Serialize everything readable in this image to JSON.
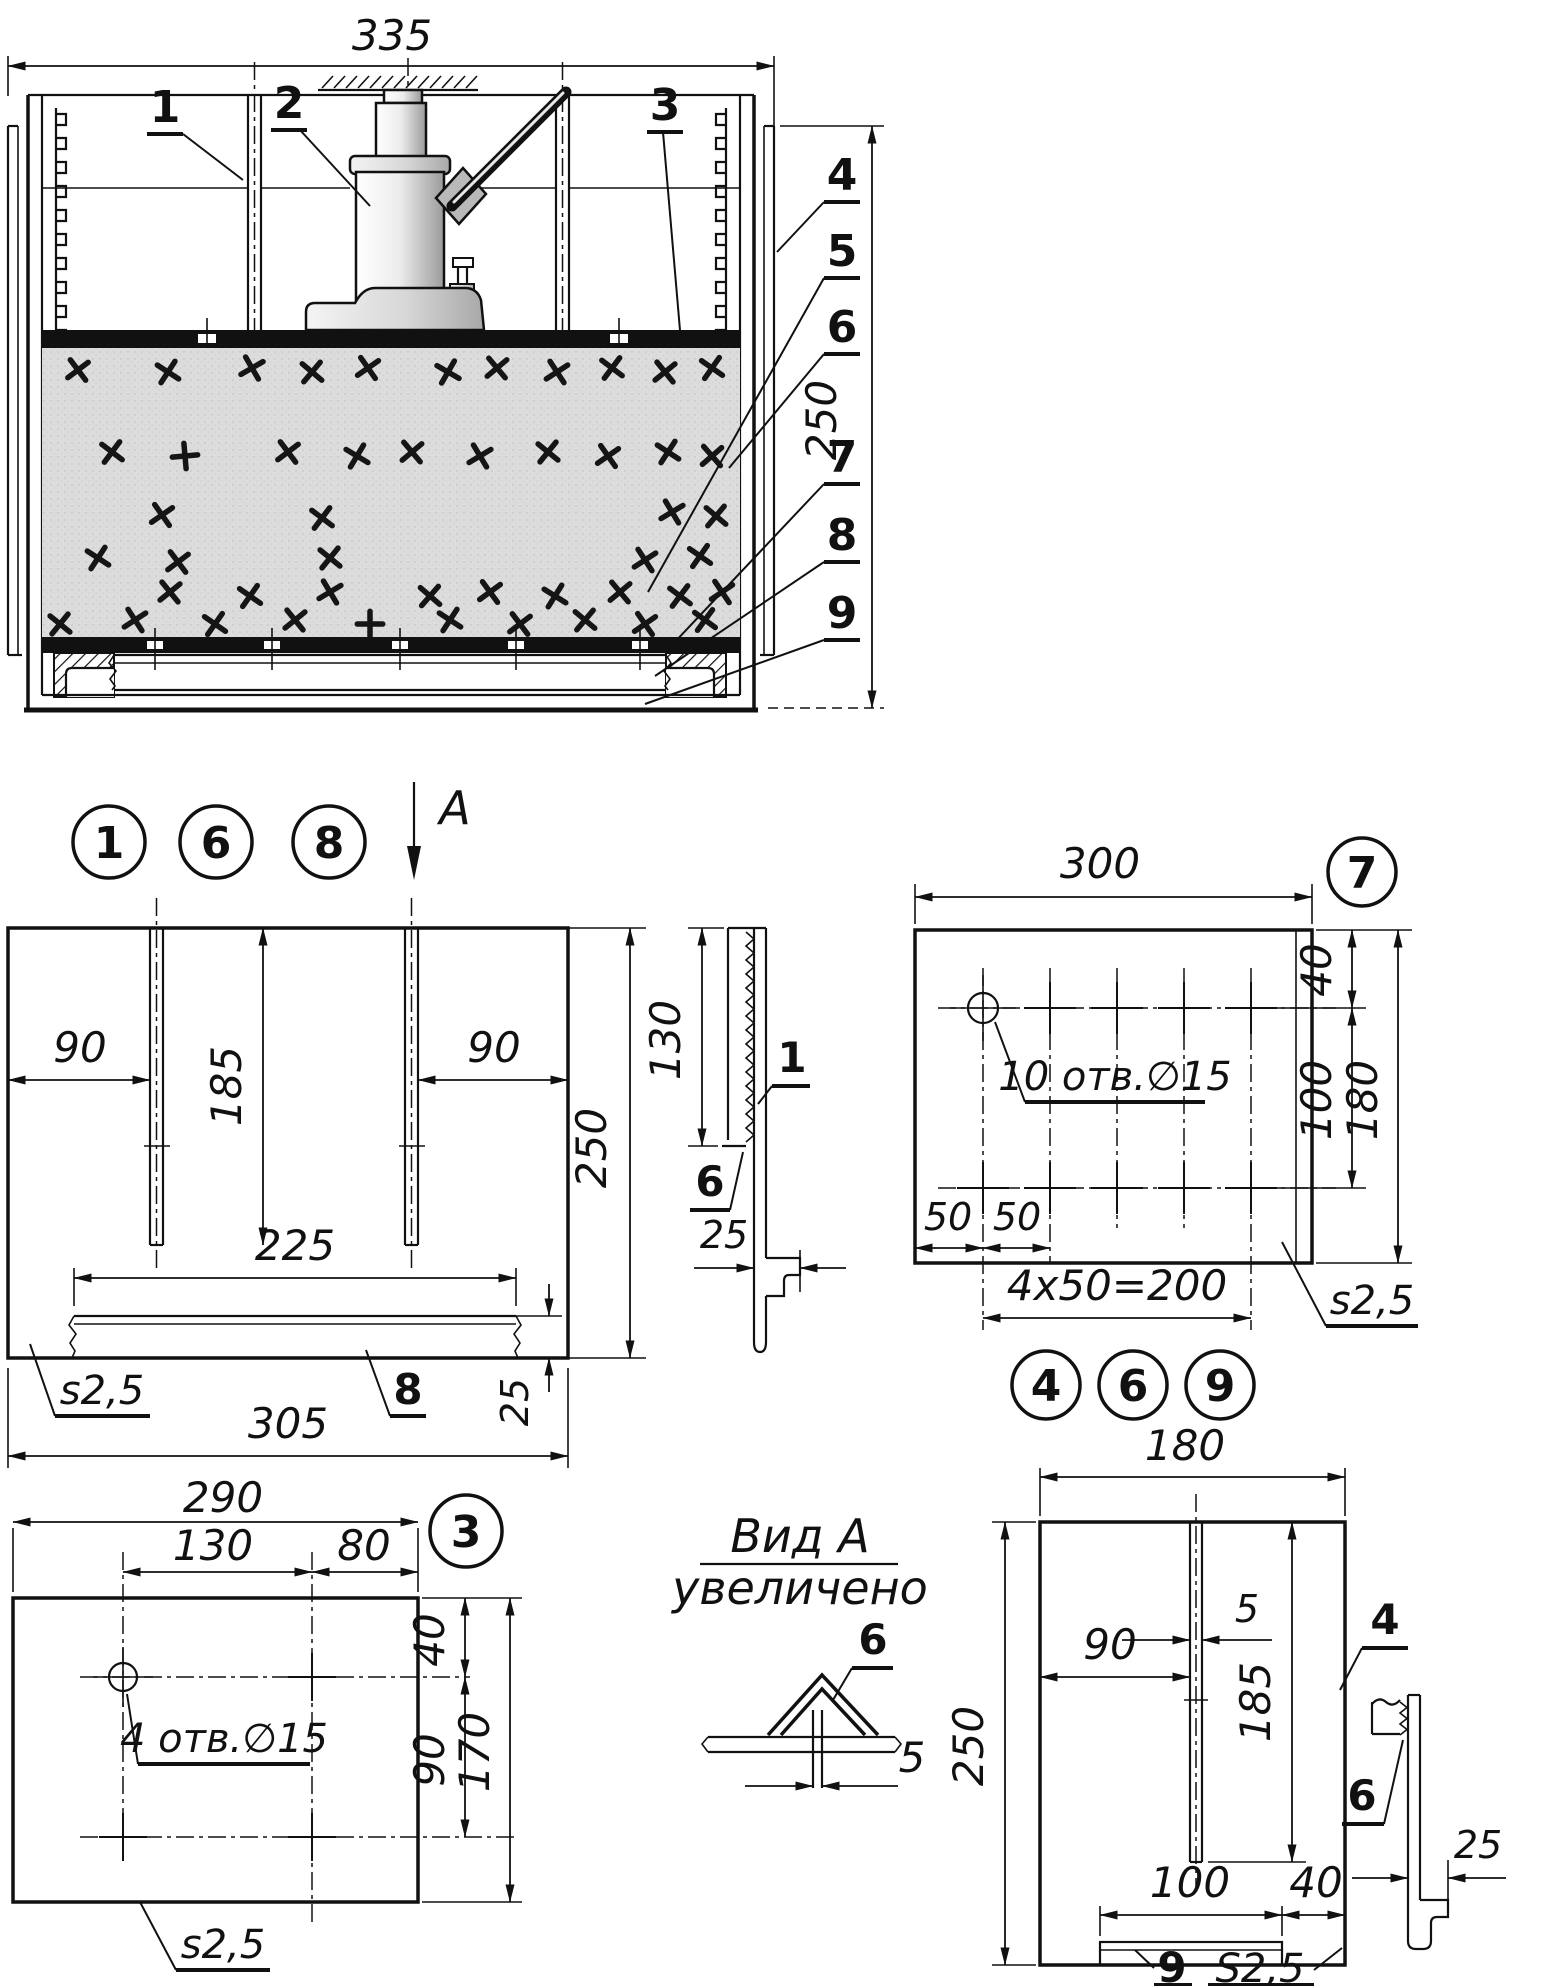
{
  "assembly": {
    "dim_width": "335",
    "dim_height": "250",
    "labels": {
      "n1": "1",
      "n2": "2",
      "n3": "3",
      "n4": "4",
      "n5": "5",
      "n6": "6",
      "n7": "7",
      "n8": "8",
      "n9": "9"
    }
  },
  "detail168": {
    "balloon_1": "1",
    "balloon_6": "6",
    "balloon_8": "8",
    "view_arrow": "A",
    "dims": {
      "left90": "90",
      "rib185": "185",
      "right90": "90",
      "height250": "250",
      "bar225": "225",
      "bar25": "25",
      "width305": "305"
    },
    "notes": {
      "thickness": "s2,5",
      "part8": "8"
    },
    "side": {
      "dim130": "130",
      "dim25": "25",
      "label1": "1",
      "label6": "6"
    }
  },
  "detail7": {
    "balloon": "7",
    "dims": {
      "width300": "300",
      "top40": "40",
      "mid100": "100",
      "height180": "180",
      "c50a": "50",
      "c50b": "50",
      "pitch": "4x50=200"
    },
    "notes": {
      "holes": "10 отв.∅15",
      "thickness": "s2,5"
    }
  },
  "detail469": {
    "balloon_4": "4",
    "balloon_6": "6",
    "balloon_9": "9",
    "dims": {
      "width180": "180",
      "rib5": "5",
      "left90": "90",
      "rib185": "185",
      "height250": "250",
      "bar100": "100",
      "right40": "40"
    },
    "notes": {
      "part4": "4",
      "part9": "9",
      "thickness": "S2,5"
    },
    "side": {
      "label6": "6",
      "dim25": "25"
    }
  },
  "detail3": {
    "balloon": "3",
    "dims": {
      "width290": "290",
      "c130": "130",
      "c80": "80",
      "top40": "40",
      "mid90": "90",
      "height170": "170"
    },
    "notes": {
      "holes": "4 отв.∅15",
      "thickness": "s2,5"
    }
  },
  "view_a": {
    "title": "Вид А",
    "subtitle": "увеличено",
    "label_angle": "6",
    "dim_rivet": "5"
  }
}
